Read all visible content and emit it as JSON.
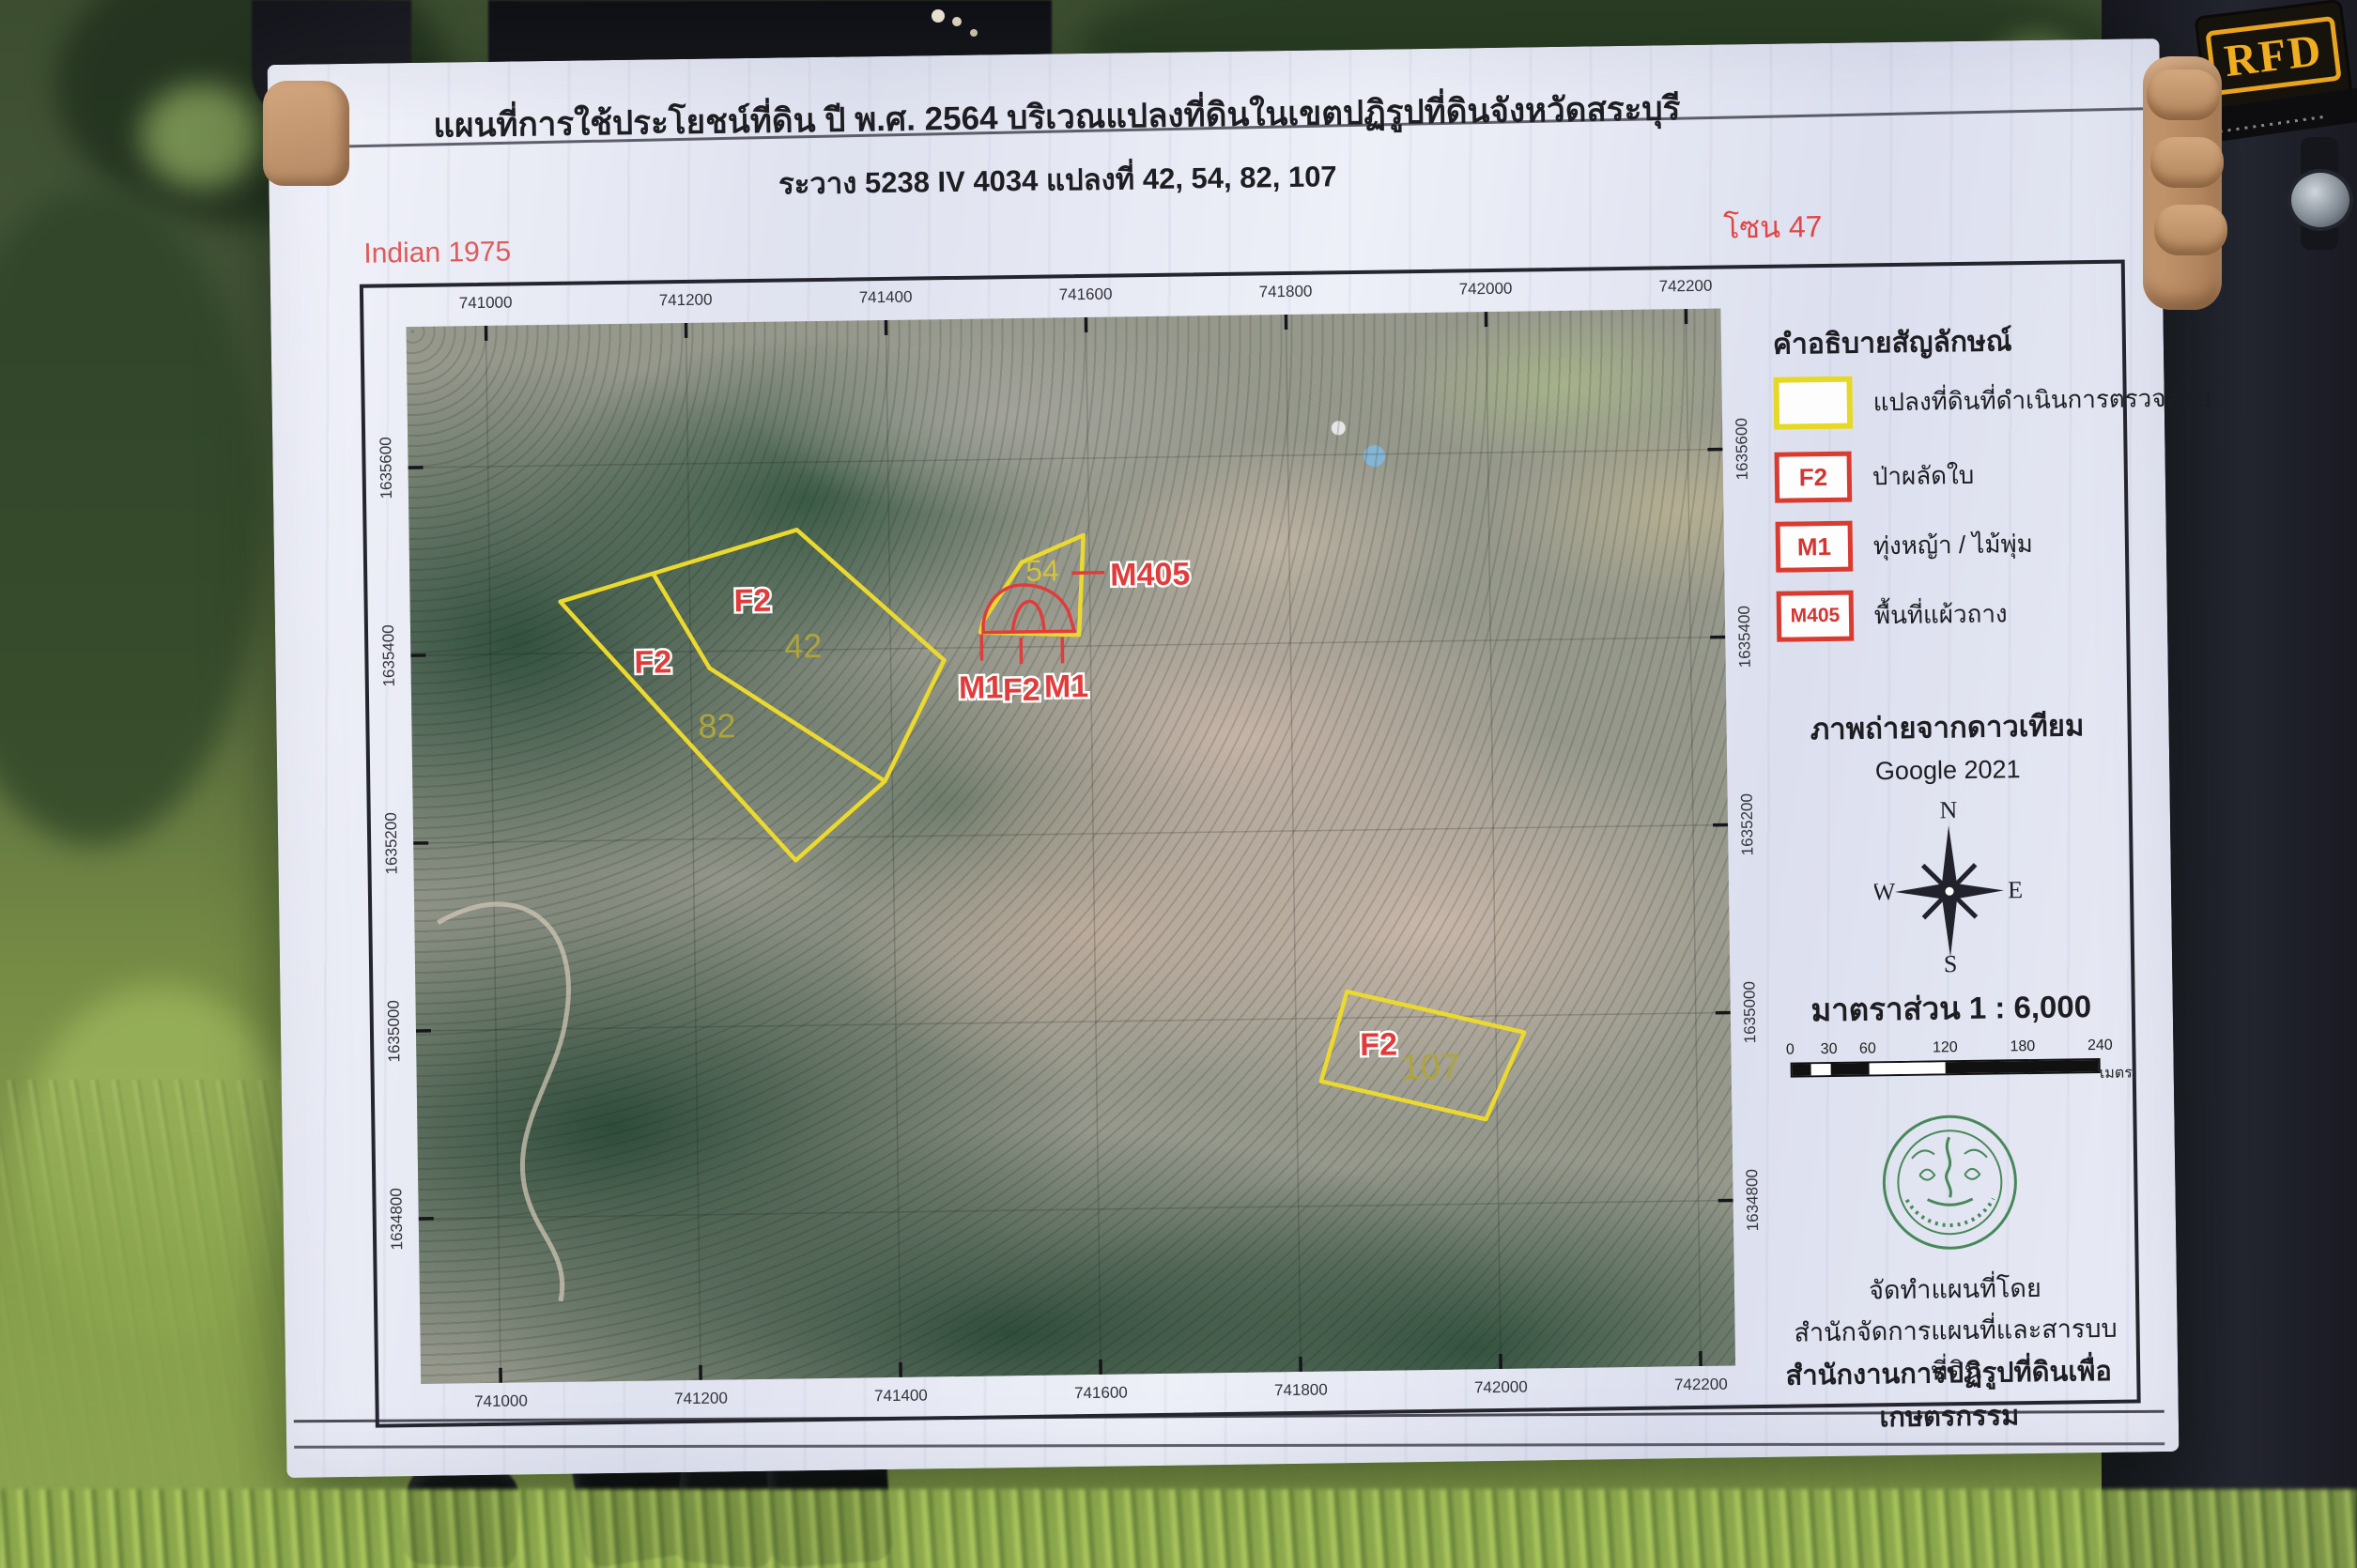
{
  "photo": {
    "rfd_patch": "RFD"
  },
  "banner": {
    "title_line1": "แผนที่การใช้ประโยชน์ที่ดิน ปี พ.ศ. 2564 บริเวณแปลงที่ดินในเขตปฏิรูปที่ดินจังหวัดสระบุรี",
    "title_line2": "ระวาง 5238 IV 4034 แปลงที่ 42, 54, 82, 107",
    "datum": "Indian 1975",
    "zone": "โซน 47",
    "colors": {
      "datum_red": "#e05a5a",
      "plot_outline_yellow": "#ecd92f",
      "label_red": "#e23b3b",
      "legend_red": "#da3b30",
      "legend_yellow": "#e5d826"
    }
  },
  "map": {
    "grid_x": [
      "741000",
      "741200",
      "741400",
      "741600",
      "741800",
      "742000",
      "742200"
    ],
    "grid_y": [
      "1635600",
      "1635400",
      "1635200",
      "1635000",
      "1634800"
    ],
    "labels": {
      "f2": "F2",
      "m1": "M1",
      "m405": "M405",
      "plot42": "42",
      "plot54": "54",
      "plot82": "82",
      "plot107": "107"
    }
  },
  "legend": {
    "title": "คำอธิบายสัญลักษณ์",
    "items": [
      {
        "symbol": "",
        "label": "แปลงที่ดินที่ดำเนินการตรวจสอบ"
      },
      {
        "symbol": "F2",
        "label": "ป่าผลัดใบ"
      },
      {
        "symbol": "M1",
        "label": "ทุ่งหญ้า / ไม้พุ่ม"
      },
      {
        "symbol": "M405",
        "label": "พื้นที่แผ้วถาง"
      }
    ]
  },
  "source": {
    "heading": "ภาพถ่ายจากดาวเทียม",
    "credit": "Google 2021",
    "compass": {
      "n": "N",
      "e": "E",
      "s": "S",
      "w": "W"
    },
    "scale_text": "มาตราส่วน 1 : 6,000",
    "scale_ticks": [
      "0",
      "30",
      "60",
      "120",
      "180",
      "240"
    ],
    "scale_unit": "เมตร"
  },
  "footer": {
    "line1": "จัดทำแผนที่โดย",
    "line2": "สำนักจัดการแผนที่และสารบบที่ดิน",
    "line3": "สำนักงานการปฏิรูปที่ดินเพื่อเกษตรกรรม"
  }
}
